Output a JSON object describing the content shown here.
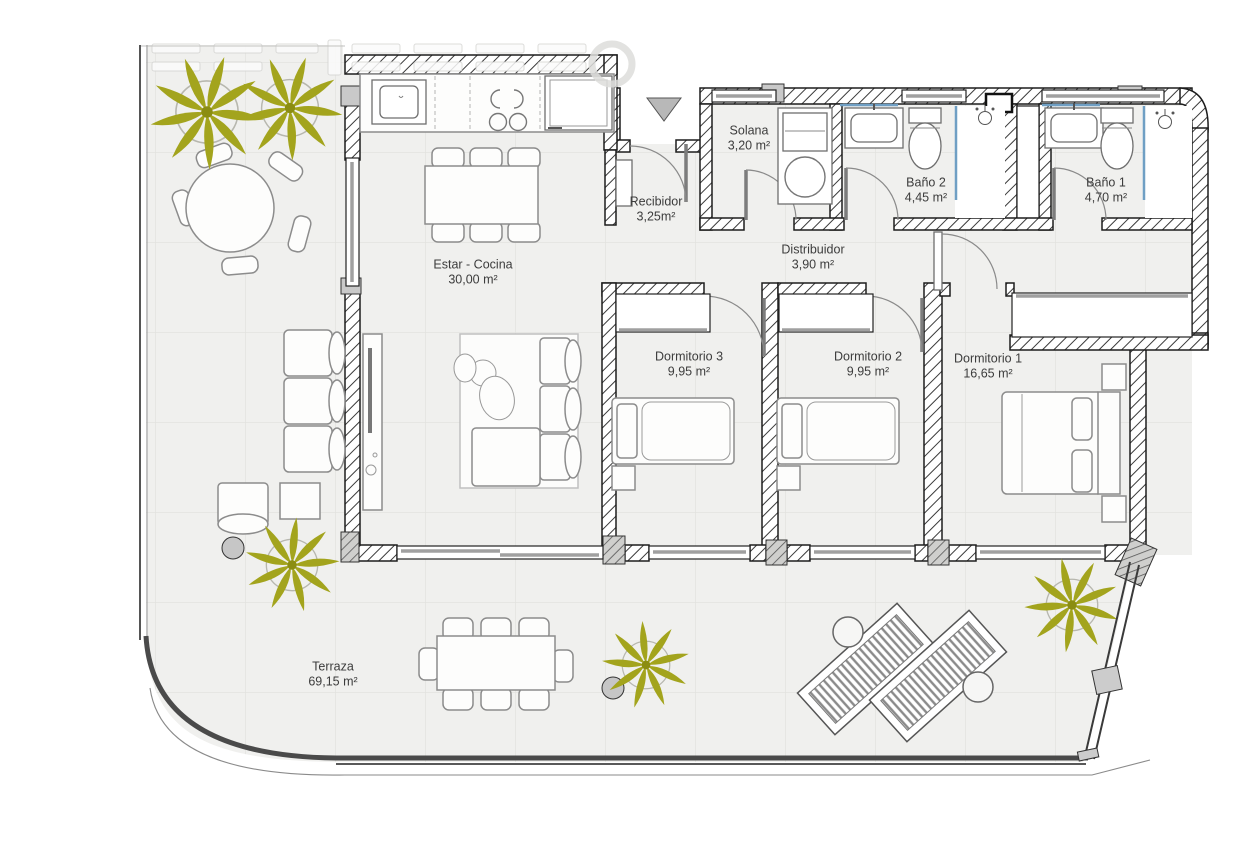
{
  "rooms": [
    {
      "name": "Estar - Cocina",
      "area": "30,00 m²"
    },
    {
      "name": "Recibidor",
      "area": "3,25m²"
    },
    {
      "name": "Solana",
      "area": "3,20 m²"
    },
    {
      "name": "Baño 2",
      "area": "4,45 m²"
    },
    {
      "name": "Baño 1",
      "area": "4,70 m²"
    },
    {
      "name": "Distribuidor",
      "area": "3,90 m²"
    },
    {
      "name": "Dormitorio 3",
      "area": "9,95 m²"
    },
    {
      "name": "Dormitorio 2",
      "area": "9,95 m²"
    },
    {
      "name": "Dormitorio 1",
      "area": "16,65 m²"
    },
    {
      "name": "Terraza",
      "area": "69,15 m²"
    }
  ],
  "colors": {
    "floor": "#f0f0ee",
    "wall_outline": "#1d1d1d",
    "palm": "#a3a41d",
    "glass_accent": "#6f9fc4",
    "column_gray": "#c9c9c9",
    "label_text": "#3c3c3c"
  }
}
